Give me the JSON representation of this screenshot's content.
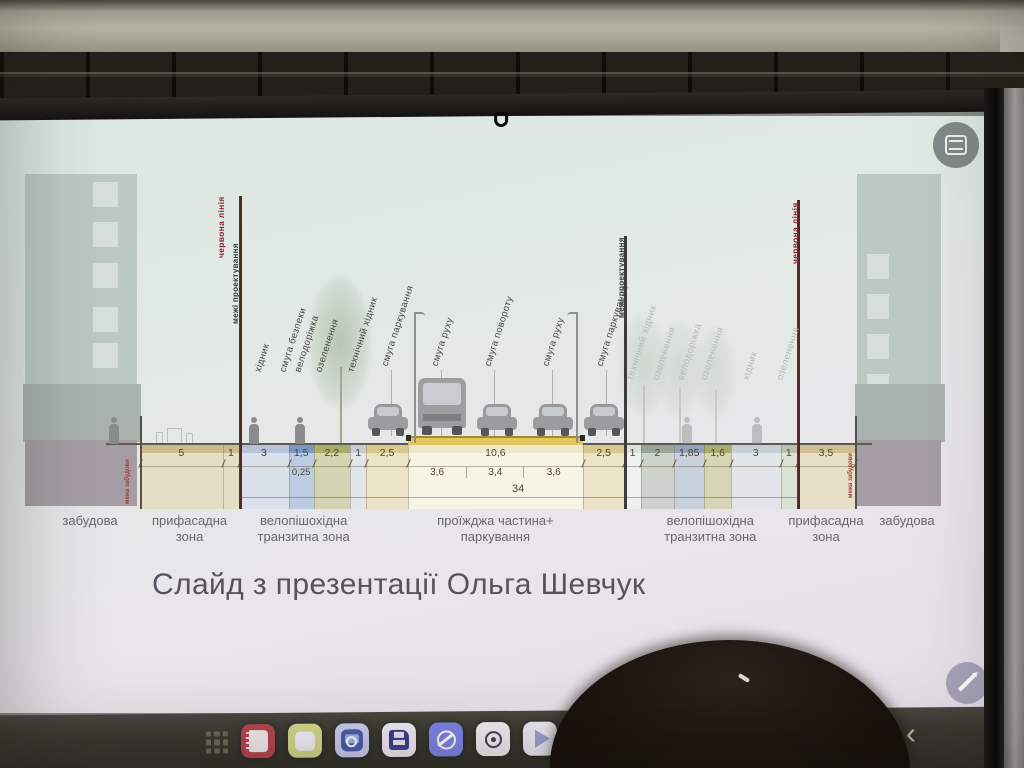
{
  "slide": {
    "caption": "Слайд з презентації Ольга Шевчук",
    "colors": {
      "bg_top": "#dbe8e1",
      "bg_bottom": "#e5dfe9",
      "red_line": "#8c1f24",
      "road_yellow": "#e5c65e",
      "band_text": "#4e4330",
      "zone_text": "#6c6570"
    },
    "buildings": {
      "left_label": "забудова",
      "right_label": "забудова",
      "left_windows": 5,
      "right_windows": 5
    },
    "total_dimension": "34",
    "segments": [
      {
        "num": "5",
        "m": 5,
        "color": "#cdbb8d"
      },
      {
        "num": "1",
        "m": 1,
        "color": "#cdbb8d"
      },
      {
        "num": "3",
        "m": 3,
        "color": "#b6c3d6"
      },
      {
        "num": "1,5",
        "m": 1.5,
        "color": "#7b97c4",
        "sub": "0,25"
      },
      {
        "num": "2,2",
        "m": 2.2,
        "color": "#a9ad67"
      },
      {
        "num": "1",
        "m": 1,
        "color": "#c2cdd7"
      },
      {
        "num": "2,5",
        "m": 2.5,
        "color": "#d9c98c"
      },
      {
        "num": "10,6",
        "m": 10.6,
        "color": "#eee8ca",
        "subs": [
          "3,6",
          "3,4",
          "3,6"
        ],
        "subs_m": [
          3.6,
          3.4,
          3.6
        ]
      },
      {
        "num": "2,5",
        "m": 2.5,
        "color": "#d9c98c"
      },
      {
        "num": "1",
        "m": 1,
        "color": "#dce2de"
      },
      {
        "num": "2",
        "m": 2,
        "color": "#9aa598"
      },
      {
        "num": "1,85",
        "m": 1.85,
        "color": "#93a3bb"
      },
      {
        "num": "1,6",
        "m": 1.6,
        "color": "#a8ac6e"
      },
      {
        "num": "3",
        "m": 3,
        "color": "#c5cdd5"
      },
      {
        "num": "1",
        "m": 1,
        "color": "#b9c3ab"
      },
      {
        "num": "3,5",
        "m": 3.5,
        "color": "#cfbe8f"
      }
    ],
    "boundary_lines": [
      {
        "m": 0,
        "type": "building",
        "top": 300,
        "labels": [
          {
            "text": "межа забудови",
            "style": "tinyred",
            "dx": -6,
            "bottom": 388
          }
        ]
      },
      {
        "m": 6,
        "type": "red",
        "top": 80,
        "labels": [
          {
            "text": "червона лінія",
            "style": "red",
            "dx": -12,
            "bottom": 142
          },
          {
            "text": "межі проектування",
            "style": "blk",
            "dx": 3,
            "bottom": 208
          }
        ]
      },
      {
        "m": 29.3,
        "type": "design",
        "top": 120,
        "labels": [
          {
            "text": "межі проектування",
            "style": "blk",
            "dx": 4,
            "bottom": 202
          }
        ]
      },
      {
        "m": 39.75,
        "type": "red",
        "top": 84,
        "labels": [
          {
            "text": "червона лінія",
            "style": "red",
            "dx": 4,
            "bottom": 148
          }
        ]
      },
      {
        "m": 43.25,
        "type": "building",
        "top": 300,
        "labels": [
          {
            "text": "межа забудови",
            "style": "tinyred",
            "dx": 2,
            "bottom": 382
          }
        ]
      }
    ],
    "vertical_labels": [
      {
        "text": "хідник",
        "m": 7.5,
        "style": "dark"
      },
      {
        "text": "смуга безпеки",
        "m": 9.0,
        "style": "dark"
      },
      {
        "text": "велодоріжка",
        "m": 9.95,
        "style": "dark"
      },
      {
        "text": "озеленення",
        "m": 11.2,
        "style": "dark"
      },
      {
        "text": "технічний хідник",
        "m": 13.1,
        "style": "dark"
      },
      {
        "text": "смуга паркування",
        "m": 15.2,
        "style": "dark",
        "leader": true
      },
      {
        "text": "смуга руху",
        "m": 18.2,
        "style": "dark",
        "leader": true
      },
      {
        "text": "смуга повороту",
        "m": 21.4,
        "style": "dark",
        "leader": true
      },
      {
        "text": "смуга руху",
        "m": 24.9,
        "style": "dark",
        "leader": true
      },
      {
        "text": "смуга паркування",
        "m": 28.2,
        "style": "dark",
        "leader": true
      },
      {
        "text": "технічний хідник",
        "m": 30.0,
        "style": "faded"
      },
      {
        "text": "озеленення",
        "m": 31.6,
        "style": "faded"
      },
      {
        "text": "велодоріжка",
        "m": 33.1,
        "style": "faded"
      },
      {
        "text": "озеленення",
        "m": 34.5,
        "style": "faded"
      },
      {
        "text": "хідник",
        "m": 37.0,
        "style": "faded"
      },
      {
        "text": "озеленення",
        "m": 39.1,
        "style": "faded"
      }
    ],
    "zone_labels": [
      {
        "text": "забудова",
        "x": 90
      },
      {
        "text": "прифасадна\nзона",
        "m": 3
      },
      {
        "text": "велопішохідна\nтранзитна зона",
        "m": 9.9
      },
      {
        "text": "проїжджа частина+\nпаркування",
        "m": 21.5
      },
      {
        "text": "велопішохідна\nтранзитна зона",
        "m": 34.5
      },
      {
        "text": "прифасадна\nзона",
        "m": 41.5
      },
      {
        "text": "забудова",
        "x": 907
      }
    ],
    "road": {
      "start_m": 16.2,
      "end_m": 26.8
    },
    "total_span": {
      "start_m": 6,
      "end_m": 39.75
    },
    "vehicles": [
      {
        "type": "car",
        "m": 15.0
      },
      {
        "type": "bus",
        "m": 18.3
      },
      {
        "type": "car",
        "m": 21.6
      },
      {
        "type": "car",
        "m": 25.0
      },
      {
        "type": "car",
        "m": 28.1
      }
    ],
    "trees": [
      {
        "m": 12.1,
        "w": 64,
        "h": 150,
        "top": 158,
        "o": 0.9
      },
      {
        "m": 30.4,
        "w": 50,
        "h": 115,
        "top": 198,
        "o": 0.45
      },
      {
        "m": 32.6,
        "w": 46,
        "h": 105,
        "top": 205,
        "o": 0.4
      },
      {
        "m": 34.8,
        "w": 42,
        "h": 98,
        "top": 210,
        "o": 0.38
      }
    ],
    "people": [
      {
        "x": 114,
        "faint": false
      },
      {
        "m": 6.9,
        "faint": false
      },
      {
        "m": 9.65,
        "faint": false
      },
      {
        "m": 33.1,
        "faint": true
      },
      {
        "m": 37.3,
        "faint": true
      }
    ],
    "lamps": [
      {
        "m": 16.6,
        "side": "l"
      },
      {
        "m": 26.4,
        "side": "r"
      }
    ]
  },
  "screen_buttons": {
    "panel_button": "slides-panel",
    "edit_button": "edit-pencil"
  },
  "dock": {
    "apps_grid": "apps-grid",
    "back_glyph": "‹",
    "icons": [
      {
        "name": "notes-app",
        "bg": "#b8454f"
      },
      {
        "name": "memo-app",
        "bg": "#d6d98c"
      },
      {
        "name": "gallery-app",
        "bg": "#c9cdf0"
      },
      {
        "name": "floppy-save-app",
        "bg": "#f0ecf4"
      },
      {
        "name": "browser-app",
        "bg": "#7f83e6"
      },
      {
        "name": "camera-app",
        "bg": "#f2eef4"
      },
      {
        "name": "video-player-app",
        "bg": "#edebf3"
      },
      {
        "name": "photo-editor-app",
        "bg": "#c2402f"
      }
    ]
  }
}
